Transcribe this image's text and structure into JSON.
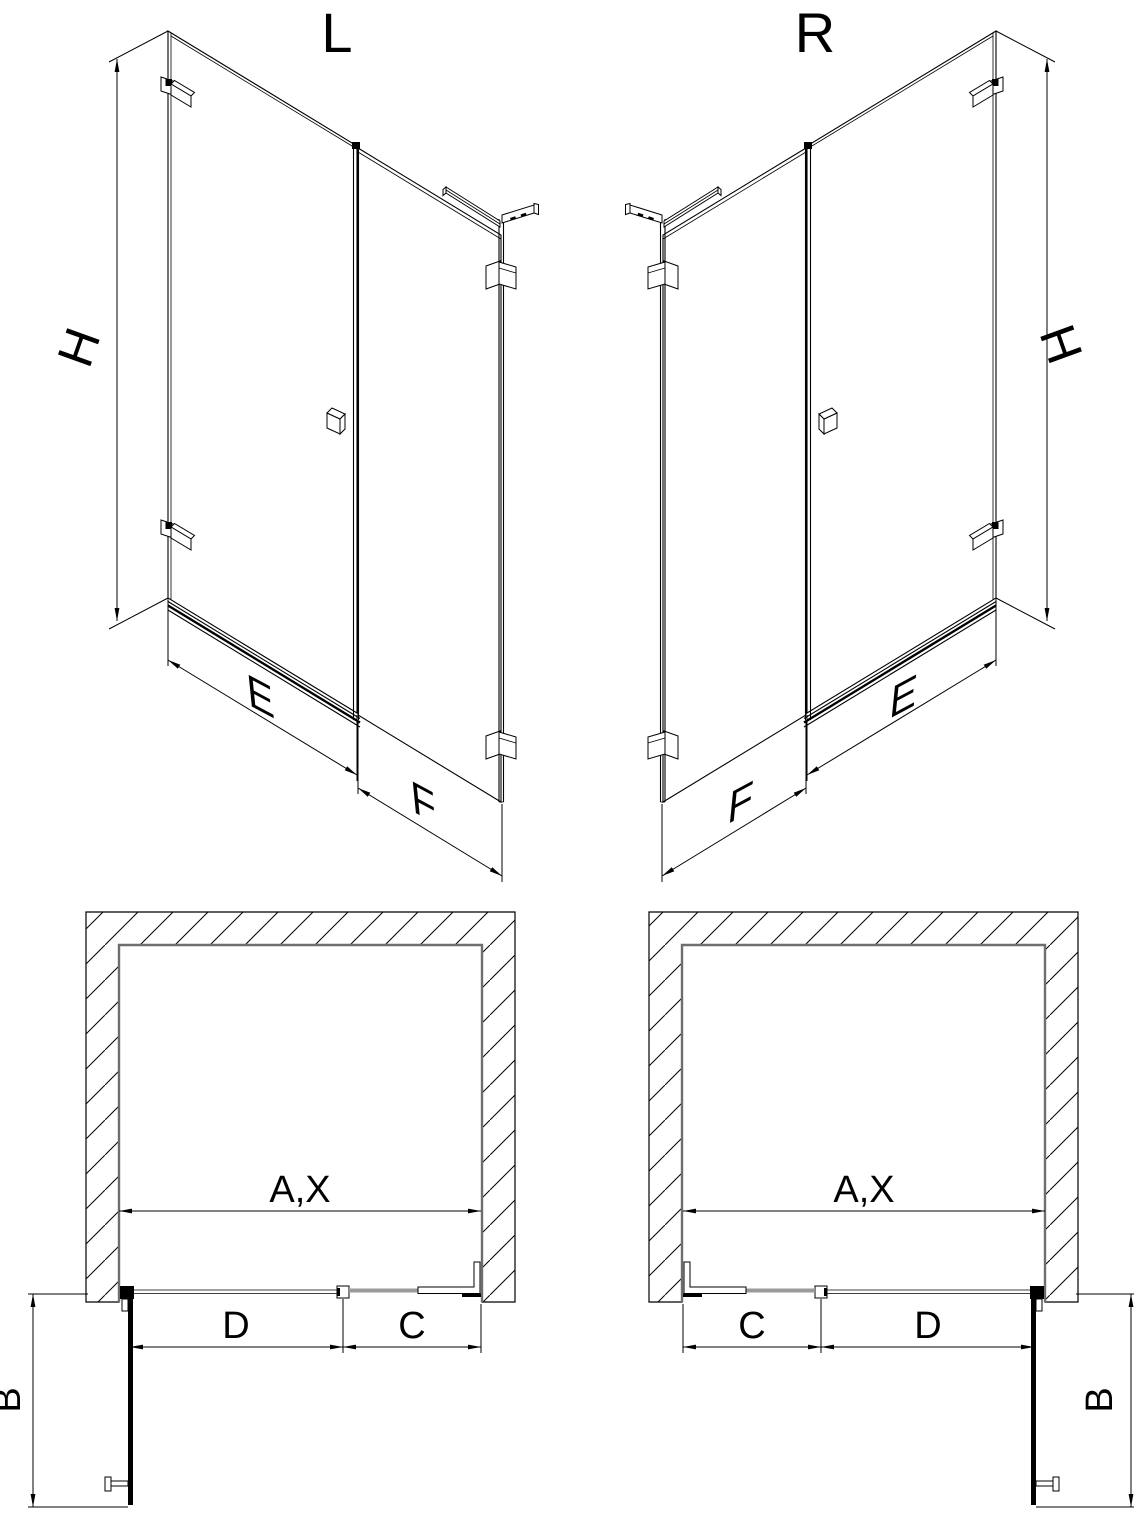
{
  "drawing": {
    "views": {
      "left_label": "L",
      "right_label": "R"
    },
    "dims": {
      "height": "H",
      "door_width": "E",
      "panel_width": "F",
      "opening_width": "A,X",
      "door_plan": "D",
      "panel_plan": "C",
      "depth": "B"
    }
  }
}
